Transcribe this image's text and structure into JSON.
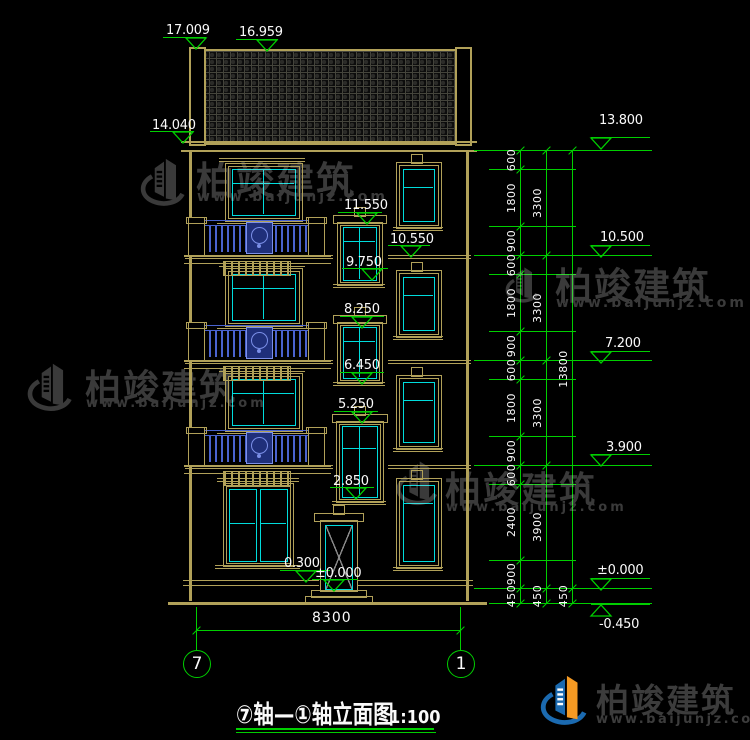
{
  "title_block": {
    "title": "⑦轴—①轴立面图",
    "scale": "1:100"
  },
  "footer": {
    "brand": "柏竣建筑",
    "url": "www.baijunjz.com"
  },
  "colors": {
    "tan": "#b1a159",
    "cyan": "#00dcdc",
    "green": "#00cf00",
    "blue": "#4a63cf",
    "panel_blue": "#1f2f7a",
    "panel_edge": "#7b8fe8",
    "white": "#fafafa",
    "watermark_gray": "#3a3a3a",
    "logo_blue": "#1b6ab0",
    "logo_orange": "#f59a23",
    "footer_text": "#3c3c3c",
    "door_swing": "#8a8a8a"
  },
  "elevation_markers": {
    "left": [
      {
        "label": "17.009",
        "tx": 166,
        "ty": 23,
        "x1": 163,
        "x2": 206,
        "ly": 37,
        "tip": 196,
        "dir": 1
      },
      {
        "label": "16.959",
        "tx": 239,
        "ty": 25,
        "x1": 236,
        "x2": 278,
        "ly": 39,
        "tip": 267,
        "dir": 1
      },
      {
        "label": "14.040",
        "tx": 152,
        "ty": 118,
        "x1": 150,
        "x2": 194,
        "ly": 131,
        "tip": 183,
        "dir": 1
      }
    ],
    "center": [
      {
        "label": "11.550",
        "tx": 344,
        "ty": 198,
        "x1": 338,
        "x2": 382,
        "ly": 212,
        "tip": 367,
        "dir": 1
      },
      {
        "label": "10.550",
        "tx": 390,
        "ty": 232,
        "x1": 388,
        "x2": 430,
        "ly": 245,
        "tip": 411,
        "dir": 1
      },
      {
        "label": "9.750",
        "tx": 346,
        "ty": 255,
        "x1": 342,
        "x2": 388,
        "ly": 268,
        "tip": 372,
        "dir": 1
      },
      {
        "label": "8.250",
        "tx": 344,
        "ty": 302,
        "x1": 340,
        "x2": 384,
        "ly": 316,
        "tip": 362,
        "dir": 1
      },
      {
        "label": "6.450",
        "tx": 344,
        "ty": 358,
        "x1": 340,
        "x2": 384,
        "ly": 372,
        "tip": 362,
        "dir": 1
      },
      {
        "label": "5.250",
        "tx": 338,
        "ty": 397,
        "x1": 334,
        "x2": 378,
        "ly": 411,
        "tip": 362,
        "dir": 1
      },
      {
        "label": "2.850",
        "tx": 333,
        "ty": 474,
        "x1": 330,
        "x2": 374,
        "ly": 487,
        "tip": 356,
        "dir": 1
      },
      {
        "label": "0.300",
        "tx": 284,
        "ty": 556,
        "x1": 280,
        "x2": 330,
        "ly": 570,
        "tip": 306,
        "dir": 1
      },
      {
        "label": "±0.000",
        "tx": 315,
        "ty": 566,
        "x1": 312,
        "x2": 358,
        "ly": 579,
        "tip": 334,
        "dir": 1
      }
    ],
    "right": [
      {
        "label": "13.800",
        "tx": 599,
        "ty": 113,
        "x1": 591,
        "x2": 650,
        "ly": 137,
        "tip": 601,
        "dir": 1
      },
      {
        "label": "10.500",
        "tx": 600,
        "ty": 230,
        "x1": 591,
        "x2": 650,
        "ly": 245,
        "tip": 601,
        "dir": 1
      },
      {
        "label": "7.200",
        "tx": 605,
        "ty": 336,
        "x1": 591,
        "x2": 650,
        "ly": 351,
        "tip": 601,
        "dir": 1
      },
      {
        "label": "3.900",
        "tx": 606,
        "ty": 440,
        "x1": 591,
        "x2": 650,
        "ly": 454,
        "tip": 601,
        "dir": 1
      },
      {
        "label": "±0.000",
        "tx": 597,
        "ty": 563,
        "x1": 591,
        "x2": 650,
        "ly": 578,
        "tip": 601,
        "dir": 1
      },
      {
        "label": "-0.450",
        "tx": 599,
        "ty": 617,
        "x1": 591,
        "x2": 650,
        "ly": 604,
        "tip": 601,
        "dir": -1
      }
    ]
  },
  "dimension_chains": {
    "vertical": [
      {
        "x": 520,
        "levels": [
          150,
          169,
          226,
          255,
          274,
          331,
          360,
          379,
          436,
          465,
          484,
          560,
          588,
          603
        ],
        "labels": [
          "600",
          "1800",
          "900",
          "600",
          "1800",
          "900",
          "600",
          "1800",
          "900",
          "600",
          "2400",
          "900",
          "450"
        ]
      },
      {
        "x": 546,
        "levels": [
          150,
          255,
          360,
          465,
          588,
          603
        ],
        "labels": [
          "3300",
          "3300",
          "3300",
          "3900",
          "450"
        ]
      },
      {
        "x": 572,
        "levels": [
          150,
          588,
          603
        ],
        "labels": [
          "13800",
          "450"
        ]
      }
    ],
    "bottom": {
      "label": "8300",
      "x1": 196,
      "x2": 460,
      "y": 630,
      "ext_top": 607,
      "ext_bottom": 650,
      "text_x": 312,
      "text_y": 610
    }
  },
  "axis_bubbles": [
    {
      "label": "7",
      "x": 183,
      "y": 650
    },
    {
      "label": "1",
      "x": 447,
      "y": 650
    }
  ],
  "watermarks": [
    {
      "brand": "柏竣建筑",
      "url": "www.baijunjz.com",
      "logo": {
        "x": 140,
        "y": 150,
        "w": 48,
        "h": 62
      },
      "brand_x": 196,
      "brand_y": 150,
      "brand_size": 38,
      "url_x": 197,
      "url_y": 189,
      "url_size": 14
    },
    {
      "brand": "柏竣建筑",
      "url": "www.baijunjz.com",
      "logo": {
        "x": 24,
        "y": 360,
        "w": 54,
        "h": 52
      },
      "brand_x": 85,
      "brand_y": 359,
      "brand_size": 36,
      "url_x": 86,
      "url_y": 396,
      "url_size": 13
    },
    {
      "brand": "柏竣建筑",
      "url": "www.baijunjz.com",
      "logo": {
        "x": 505,
        "y": 255,
        "w": 36,
        "h": 58
      },
      "brand_x": 555,
      "brand_y": 256,
      "brand_size": 37,
      "url_x": 556,
      "url_y": 295,
      "url_size": 14
    },
    {
      "brand": "柏竣建筑",
      "url": "www.baijunjz.com",
      "logo": {
        "x": 395,
        "y": 458,
        "w": 46,
        "h": 48
      },
      "brand_x": 445,
      "brand_y": 461,
      "brand_size": 36,
      "url_x": 446,
      "url_y": 500,
      "url_size": 13
    }
  ],
  "facade": {
    "wall": {
      "left_x": 189,
      "right_x": 466,
      "top": 152,
      "bottom": 601,
      "w": 3
    },
    "roof": {
      "x": 200,
      "y": 49,
      "w": 257,
      "h": 92,
      "posts": [
        [
          189,
          47,
          13,
          95
        ],
        [
          455,
          47,
          13,
          95
        ]
      ],
      "eave": {
        "x": 181,
        "y": 141,
        "w": 296,
        "h": 7
      },
      "cornice_y": 151
    },
    "floor_bands": {
      "levels": [
        255,
        360,
        465
      ],
      "seg1": [
        185,
        333
      ],
      "seg2": [
        388,
        471
      ],
      "ground": {
        "y": 580,
        "y2": 585,
        "seg1": [
          183,
          319
        ],
        "seg2": [
          357,
          473
        ]
      }
    },
    "ground_line": {
      "x": 168,
      "y": 602,
      "w": 319,
      "h": 3
    },
    "left_windows": {
      "tops": [
        163,
        268,
        373
      ]
    },
    "ground_window": {
      "top": 483
    },
    "center_windows": [
      {
        "x": 337,
        "top": 222,
        "w": 44,
        "h": 62,
        "mull": 14
      },
      {
        "x": 337,
        "top": 322,
        "w": 44,
        "h": 60,
        "mull": 14
      },
      {
        "x": 336,
        "top": 421,
        "w": 46,
        "h": 80,
        "mull": 22
      }
    ],
    "right_windows": [
      {
        "top": 162,
        "h": 65
      },
      {
        "top": 270,
        "h": 66
      },
      {
        "top": 375,
        "h": 73
      },
      {
        "top": 478,
        "h": 89
      }
    ],
    "door": {
      "x": 320,
      "top": 520,
      "w": 36,
      "h": 70
    },
    "balconies": {
      "levels": [
        255,
        360,
        465
      ]
    }
  }
}
